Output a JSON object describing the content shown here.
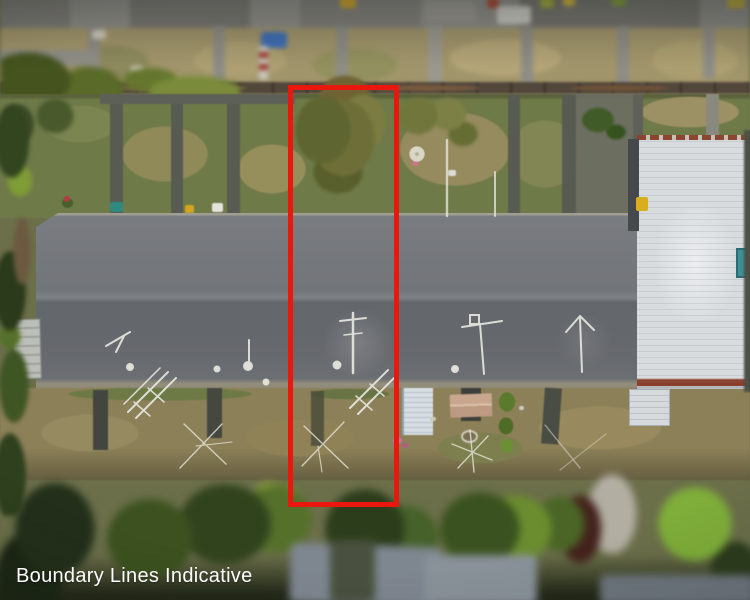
{
  "overlay": {
    "watermark": "Boundary Lines Indicative"
  },
  "colors": {
    "boundary_red": "#e9170e",
    "watermark_white": "#ffffff",
    "roof_gray": "#6f7378",
    "white_roof": "#d8dcdf",
    "lawn_green": "#6f7a49",
    "dry_grass": "#8c8058",
    "tree_dark": "#2c3a1e",
    "tree_bright": "#7fae3a",
    "fence_brown": "#52473b",
    "tarp_blue": "#3f6fb5",
    "teal_bin": "#3e8f96"
  },
  "scene": {
    "description": "Aerial drone photo of a long grey-roofed terraced block; rear lawns with concrete paths above, front yards with clotheslines and sheds below, a tall white-roofed building at right, neighbouring roofs at top, tree canopy at bottom; one unit outlined with a red indicative boundary rectangle."
  }
}
